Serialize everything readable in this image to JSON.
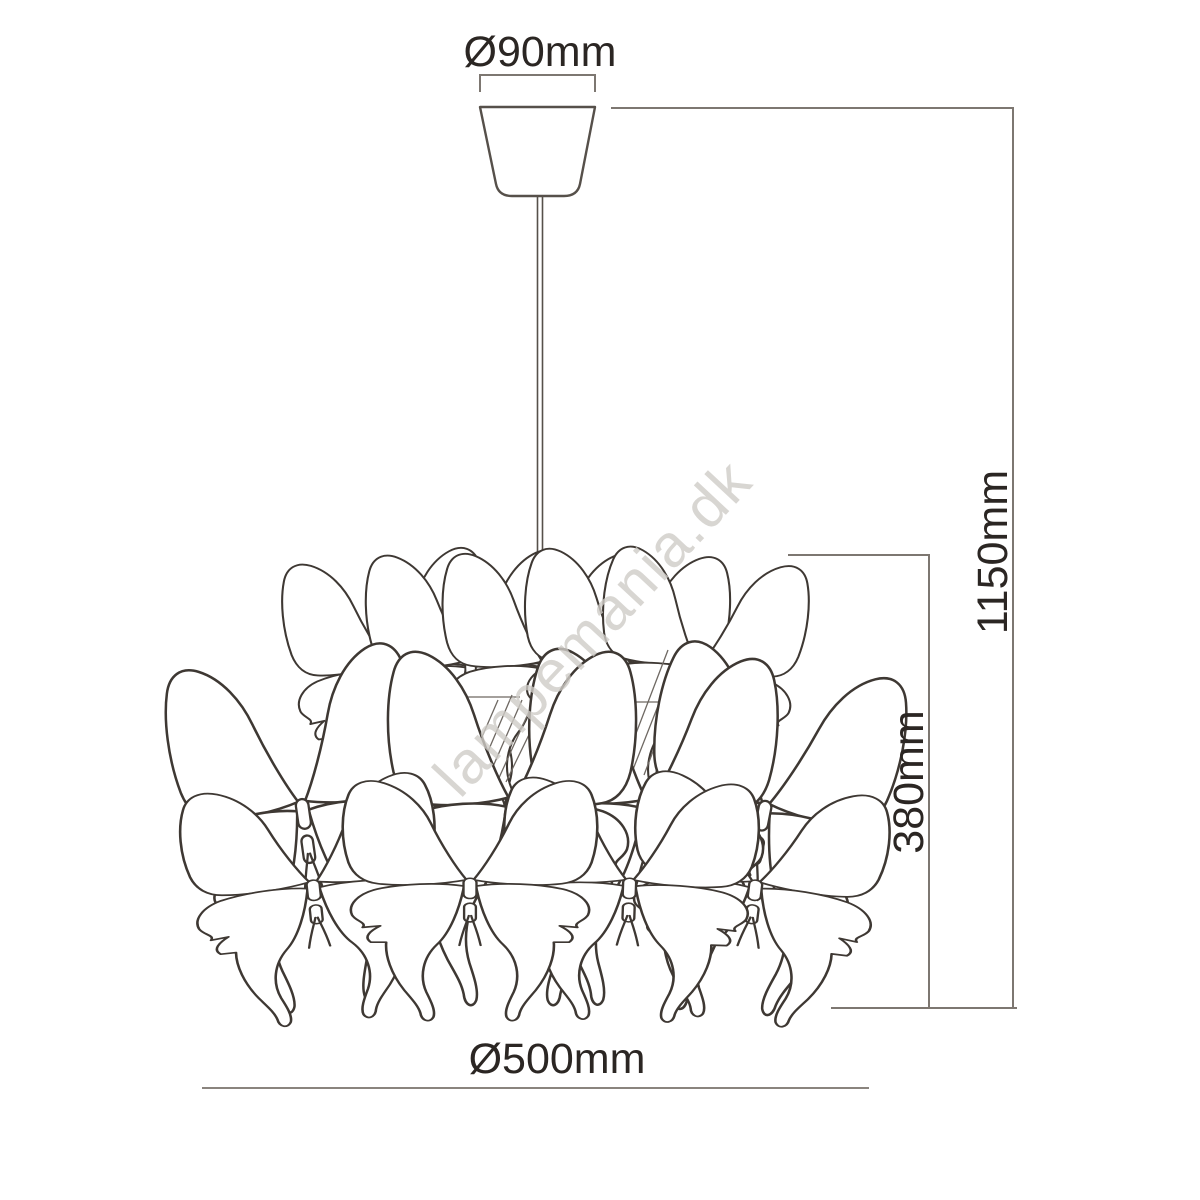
{
  "diagram": {
    "subject": "butterfly-pendant-lamp-dimension-drawing",
    "watermark": "lampemania.dk",
    "labels": {
      "canopy_diameter": "Ø90mm",
      "total_height": "1150mm",
      "shade_height": "380mm",
      "shade_diameter": "Ø500mm"
    },
    "colors": {
      "outline": "#3e3833",
      "dimension_line": "#7d7771",
      "label_text": "#2b2623",
      "watermark": "#cfccc7",
      "background": "#ffffff"
    }
  }
}
